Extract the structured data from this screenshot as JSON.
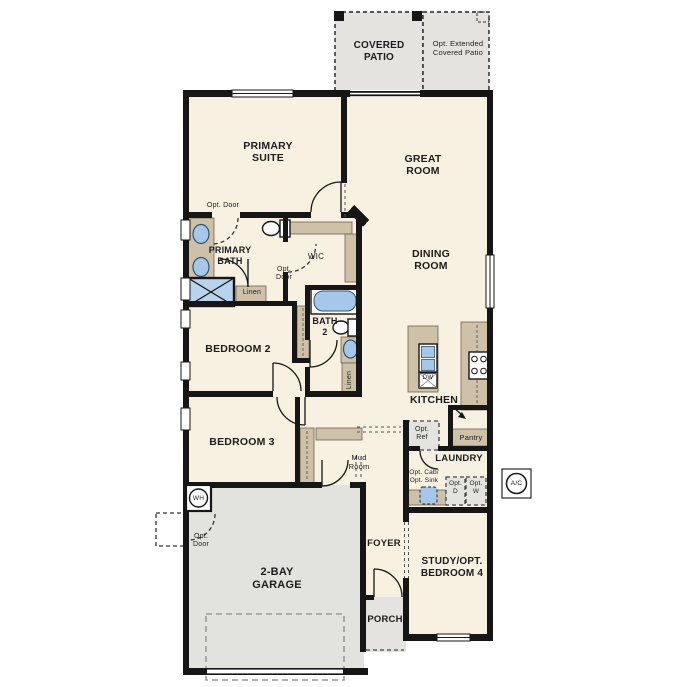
{
  "plan_title": "Single-story floor plan",
  "colors": {
    "wall": "#161616",
    "room_fill": "#f8f0e1",
    "patio_garage_fill": "#e4e3e0",
    "counter_tan": "#cec1a7",
    "fixture_blue": "#a5c7e9",
    "optional_box_fill": "#e3e3df"
  },
  "labels": {
    "covered_patio": "COVERED\nPATIO",
    "opt_extended_patio": "Opt. Extended\nCovered Patio",
    "primary_suite": "PRIMARY\nSUITE",
    "great_room": "GREAT\nROOM",
    "dining_room": "DINING\nROOM",
    "primary_bath": "PRIMARY\nBATH",
    "wic": "WIC",
    "opt_door": "Opt. Door",
    "linen": "Linen",
    "bath_2": "BATH\n2",
    "bedroom_2": "BEDROOM 2",
    "bedroom_3": "BEDROOM 3",
    "kitchen": "KITCHEN",
    "dw": "DW",
    "opt_ref": "Opt.\nRef",
    "pantry": "Pantry",
    "laundry": "LAUNDRY",
    "mud_room": "Mud\nRoom",
    "opt_cab_sink": "Opt. Cab/\nOpt. Sink",
    "opt_d": "Opt.\nD",
    "opt_w": "Opt.\nW",
    "ac": "A/C",
    "wh": "WH",
    "foyer": "FOYER",
    "study": "STUDY/OPT.\nBEDROOM 4",
    "garage": "2-BAY\nGARAGE",
    "porch": "PORCH"
  }
}
